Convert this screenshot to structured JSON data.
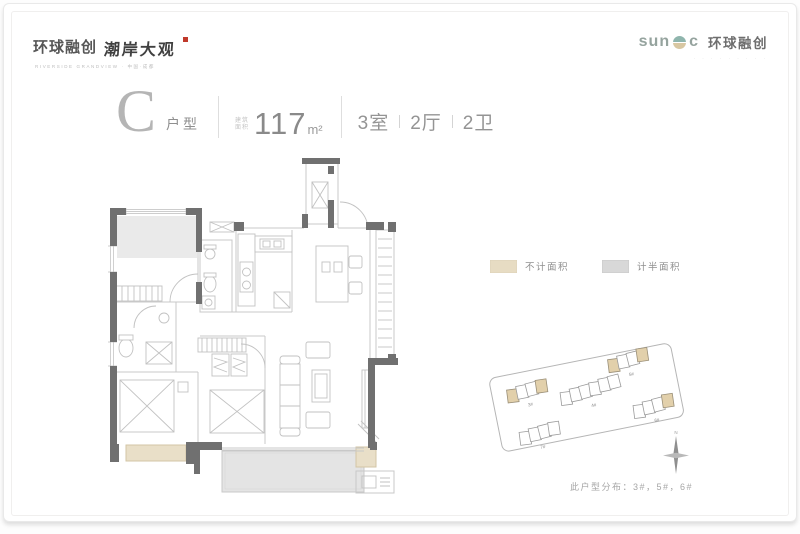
{
  "header": {
    "left_logo": {
      "brand": "环球融创",
      "project": "潮岸大观",
      "seal_color": "#c0392b",
      "caption": "RIVERSIDE GRANDVIEW · 中国·成都"
    },
    "right_logo": {
      "prefix": "sun",
      "suffix": "c",
      "brand": "环球融创",
      "tagline": "· · · · · · · · ·",
      "globe_top_color": "#8fb5ad",
      "globe_bottom_color": "#d8c7a2"
    }
  },
  "title": {
    "letter": "C",
    "letter_label": "户型",
    "area_caption_line1": "建筑",
    "area_caption_line2": "面积",
    "area_value": "117",
    "area_unit": "m²",
    "rooms": "3室",
    "halls": "2厅",
    "baths": "2卫"
  },
  "legend": {
    "items": [
      {
        "label": "不计面积",
        "color": "#e7dcc3"
      },
      {
        "label": "计半面积",
        "color": "#d8d8d8"
      }
    ]
  },
  "siteplan": {
    "buildings": [
      {
        "label": "3#",
        "highlighted": true
      },
      {
        "label": "4#",
        "highlighted": false
      },
      {
        "label": "5#",
        "highlighted": true
      },
      {
        "label": "6#",
        "highlighted": true
      },
      {
        "label": "7#",
        "highlighted": false
      }
    ],
    "north_label": "N",
    "caption": "此户型分布：3#，5#，6#"
  },
  "floorplan": {
    "colors": {
      "wall": "#707070",
      "line": "#c8c8c8",
      "shade": "#eaeaea",
      "balcony": "#e4e4e4",
      "beige": "#e9dfc8"
    }
  }
}
